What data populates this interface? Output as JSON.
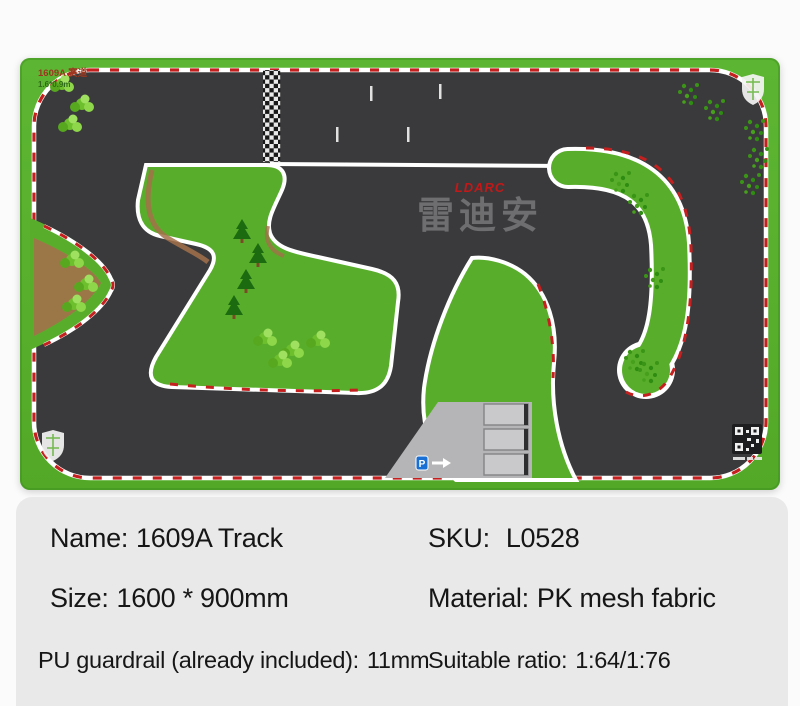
{
  "page": {
    "background": "#fbfbfb",
    "panel_background": "#e9e9e9"
  },
  "mat": {
    "corner_label": {
      "line1": "1609A 赛道",
      "line2": "1.6*0.9m"
    },
    "logo": {
      "brand": "LDARC",
      "chinese": "雷迪安"
    },
    "parking": {
      "sign": "P"
    },
    "colors": {
      "grass": "#58ae2b",
      "grass_light": "#72c53e",
      "track": "#3a3a3c",
      "curb_red": "#c42020",
      "edge_white": "#ffffff",
      "dirt": "#a3714a",
      "parking_gray": "#b5b5b7",
      "logo_red": "#c21818",
      "logo_gray": "#6e6e70"
    }
  },
  "specs": {
    "name": {
      "label": "Name:",
      "value": "1609A Track"
    },
    "sku": {
      "label": "SKU:",
      "value": "L0528"
    },
    "size": {
      "label": "Size:",
      "value": "1600 * 900mm"
    },
    "material": {
      "label": "Material:",
      "value": "PK mesh fabric"
    },
    "guardrail": {
      "label": "PU guardrail (already included):",
      "value": "11mm"
    },
    "ratio": {
      "label": "Suitable ratio:",
      "value": "1:64/1:76"
    }
  }
}
